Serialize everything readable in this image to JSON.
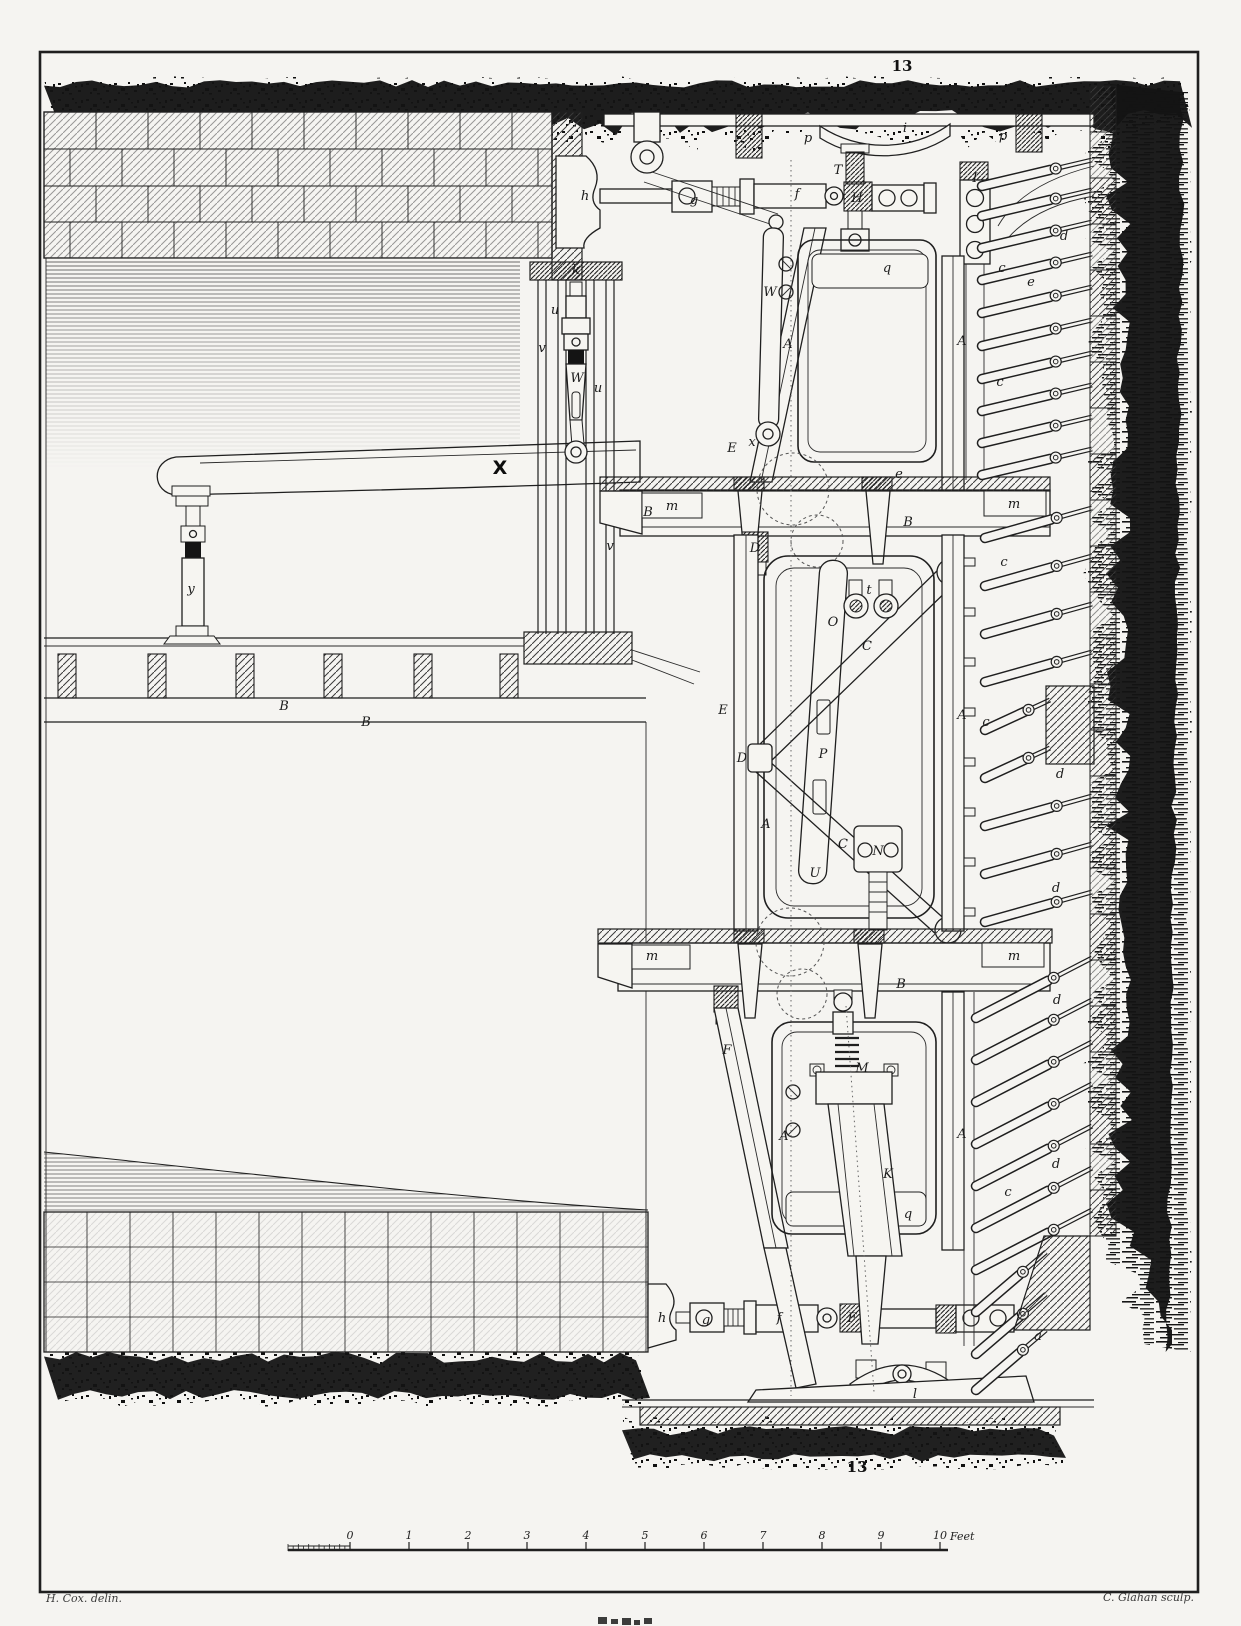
{
  "plate": {
    "figure_number_top": "13",
    "figure_number_bottom": "13",
    "signature_left": "H. Cox. delin.",
    "signature_right": "C. Glahan sculp.",
    "paper_color": "#f5f4f1",
    "ink_color": "#1f1f1f",
    "dark_band_color": "#141414"
  },
  "scale_bar": {
    "tick_labels": [
      "0",
      "1",
      "2",
      "3",
      "4",
      "5",
      "6",
      "7",
      "8",
      "9",
      "10"
    ],
    "unit_label": "Feet"
  },
  "part_labels": [
    {
      "t": "p",
      "x": 808,
      "y": 142
    },
    {
      "t": "i",
      "x": 905,
      "y": 132
    },
    {
      "t": "p",
      "x": 1003,
      "y": 140
    },
    {
      "t": "h",
      "x": 585,
      "y": 200
    },
    {
      "t": "g",
      "x": 694,
      "y": 204
    },
    {
      "t": "f",
      "x": 797,
      "y": 198
    },
    {
      "t": "H",
      "x": 857,
      "y": 202
    },
    {
      "t": "T",
      "x": 838,
      "y": 174
    },
    {
      "t": "I",
      "x": 975,
      "y": 182
    },
    {
      "t": "e",
      "x": 1031,
      "y": 286
    },
    {
      "t": "k",
      "x": 576,
      "y": 274
    },
    {
      "t": "u",
      "x": 555,
      "y": 314
    },
    {
      "t": "v",
      "x": 542,
      "y": 352
    },
    {
      "t": "W",
      "x": 577,
      "y": 382
    },
    {
      "t": "u",
      "x": 598,
      "y": 392
    },
    {
      "t": "W",
      "x": 770,
      "y": 296
    },
    {
      "t": "q",
      "x": 887,
      "y": 272
    },
    {
      "t": "A",
      "x": 788,
      "y": 348
    },
    {
      "t": "A",
      "x": 962,
      "y": 345
    },
    {
      "t": "E",
      "x": 732,
      "y": 452
    },
    {
      "t": "x",
      "x": 752,
      "y": 446
    },
    {
      "t": "B",
      "x": 648,
      "y": 516
    },
    {
      "t": "m",
      "x": 672,
      "y": 510
    },
    {
      "t": "B",
      "x": 908,
      "y": 526
    },
    {
      "t": "m",
      "x": 1014,
      "y": 508
    },
    {
      "t": "v",
      "x": 610,
      "y": 550
    },
    {
      "t": "e",
      "x": 899,
      "y": 478
    },
    {
      "t": "D",
      "x": 755,
      "y": 552
    },
    {
      "t": "t",
      "x": 869,
      "y": 594
    },
    {
      "t": "O",
      "x": 833,
      "y": 626
    },
    {
      "t": "C",
      "x": 867,
      "y": 650
    },
    {
      "t": "E",
      "x": 723,
      "y": 714
    },
    {
      "t": "A",
      "x": 962,
      "y": 719
    },
    {
      "t": "D",
      "x": 742,
      "y": 762
    },
    {
      "t": "P",
      "x": 823,
      "y": 758
    },
    {
      "t": "A",
      "x": 766,
      "y": 828
    },
    {
      "t": "U",
      "x": 815,
      "y": 877
    },
    {
      "t": "N",
      "x": 878,
      "y": 855
    },
    {
      "t": "C",
      "x": 843,
      "y": 848
    },
    {
      "t": "m",
      "x": 652,
      "y": 960
    },
    {
      "t": "B",
      "x": 901,
      "y": 988
    },
    {
      "t": "m",
      "x": 1014,
      "y": 960
    },
    {
      "t": "F",
      "x": 727,
      "y": 1054
    },
    {
      "t": "M",
      "x": 862,
      "y": 1072
    },
    {
      "t": "A",
      "x": 784,
      "y": 1140
    },
    {
      "t": "A",
      "x": 962,
      "y": 1138
    },
    {
      "t": "K",
      "x": 888,
      "y": 1178
    },
    {
      "t": "q",
      "x": 908,
      "y": 1218
    },
    {
      "t": "h",
      "x": 662,
      "y": 1322
    },
    {
      "t": "g",
      "x": 706,
      "y": 1324
    },
    {
      "t": "f",
      "x": 779,
      "y": 1322
    },
    {
      "t": "F",
      "x": 852,
      "y": 1322
    },
    {
      "t": "l",
      "x": 915,
      "y": 1398
    },
    {
      "t": "a",
      "x": 1038,
      "y": 1340
    },
    {
      "t": "y",
      "x": 191,
      "y": 593
    },
    {
      "t": "B",
      "x": 284,
      "y": 710
    },
    {
      "t": "B",
      "x": 366,
      "y": 726
    },
    {
      "t": "X",
      "x": 500,
      "y": 474,
      "b": 1
    },
    {
      "t": "d",
      "x": 1064,
      "y": 240
    },
    {
      "t": "c",
      "x": 1002,
      "y": 272
    },
    {
      "t": "c",
      "x": 1000,
      "y": 386
    },
    {
      "t": "c",
      "x": 1004,
      "y": 566
    },
    {
      "t": "c",
      "x": 986,
      "y": 726
    },
    {
      "t": "d",
      "x": 1060,
      "y": 778
    },
    {
      "t": "d",
      "x": 1056,
      "y": 892
    },
    {
      "t": "d",
      "x": 1057,
      "y": 1004
    },
    {
      "t": "d",
      "x": 1056,
      "y": 1168
    },
    {
      "t": "c",
      "x": 1008,
      "y": 1196
    }
  ]
}
